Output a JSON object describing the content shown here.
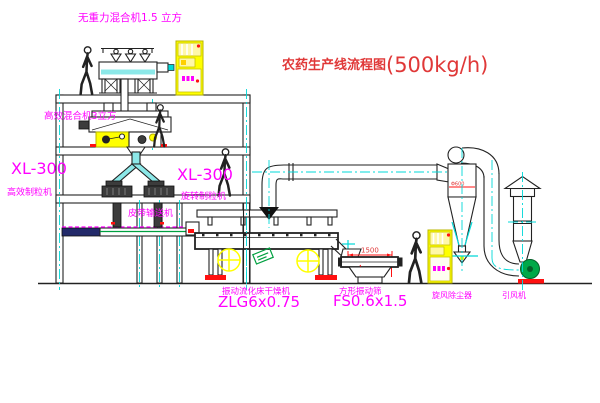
{
  "title": {
    "name": "农药生产线流程图",
    "capacity": "(500kg/h)"
  },
  "equipment": {
    "mixer_top": "无重力混合机1.5 立方",
    "mixer_mid": "高效混合机3立方",
    "granulator_left_model": "XL-300",
    "granulator_left_name": "高效制粒机",
    "granulator_right_model": "XL-300",
    "granulator_right_name": "旋转制粒机",
    "belt_conveyor": "皮带输送机",
    "dryer_name": "振动流化床干燥机",
    "dryer_model": "ZLG6x0.75",
    "sieve_name": "方形振动筛",
    "sieve_model": "FS0.6x1.5",
    "cyclone": "旋风除尘器",
    "fan": "引风机"
  },
  "dimensions": {
    "sieve_length": "1500",
    "cyclone_diameter": "Φ600"
  },
  "colors": {
    "line": "#222222",
    "label_magenta": "#ff00ff",
    "title_red": "#e03838",
    "dim_red": "#ff1010",
    "centerline_cyan": "#00d8d8",
    "cabinet_yellow": "#ffff00",
    "fan_green": "#00a040"
  }
}
